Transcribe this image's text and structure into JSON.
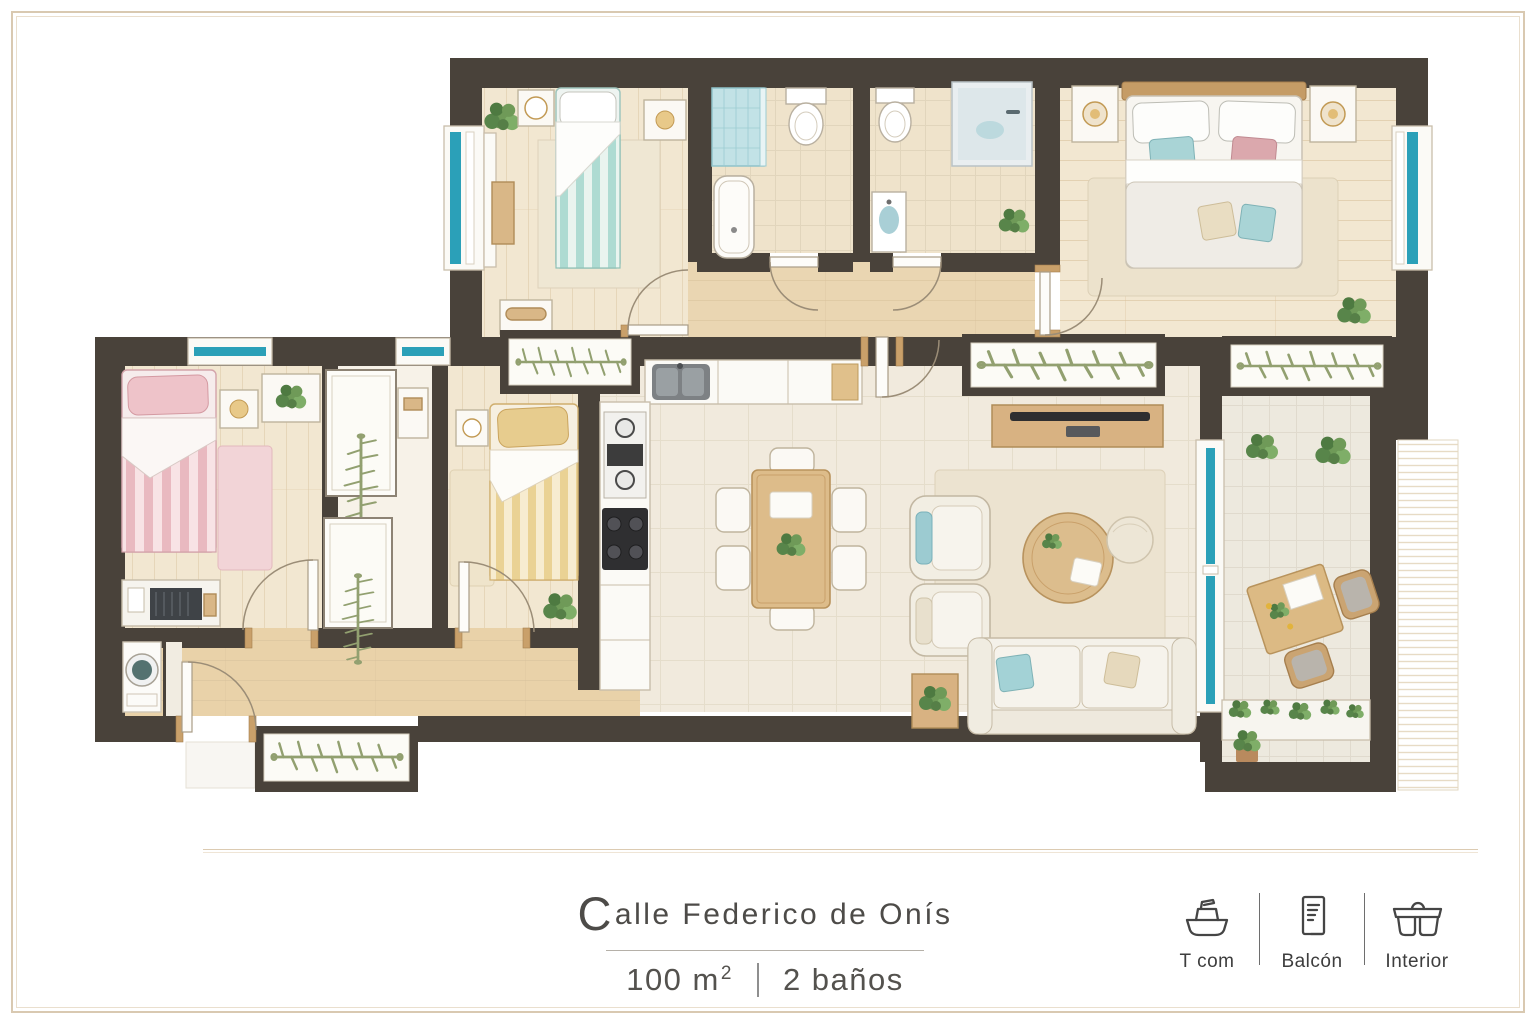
{
  "listing": {
    "street_initial": "C",
    "street_rest": "alle Federico de Onís",
    "area_base": "100 m",
    "area_exponent": "2",
    "baths": "2 baños"
  },
  "legend": {
    "items": [
      {
        "label": "T com",
        "icon": "boat-icon"
      },
      {
        "label": "Balcón",
        "icon": "balcony-door-icon"
      },
      {
        "label": "Interior",
        "icon": "sofa-glasses-icon"
      }
    ]
  },
  "colors": {
    "background": "#ffffff",
    "frame_border": "#d9c9b1",
    "wall": "#49423a",
    "window_glass_teal": "#2ba0b8",
    "floor_wood": "#ead6b2",
    "floor_room": "#f2e7d1",
    "floor_tile": "#f1eadd",
    "floor_bath": "#efe3cb",
    "bed_teal": "#abd9d2",
    "bed_pink": "#e9bac1",
    "bed_yellow": "#e8d09a",
    "furniture_wood": "#d9b787",
    "plant_green": "#6f9a58",
    "botanical_green": "#92a070",
    "text": "#4d4b48"
  }
}
